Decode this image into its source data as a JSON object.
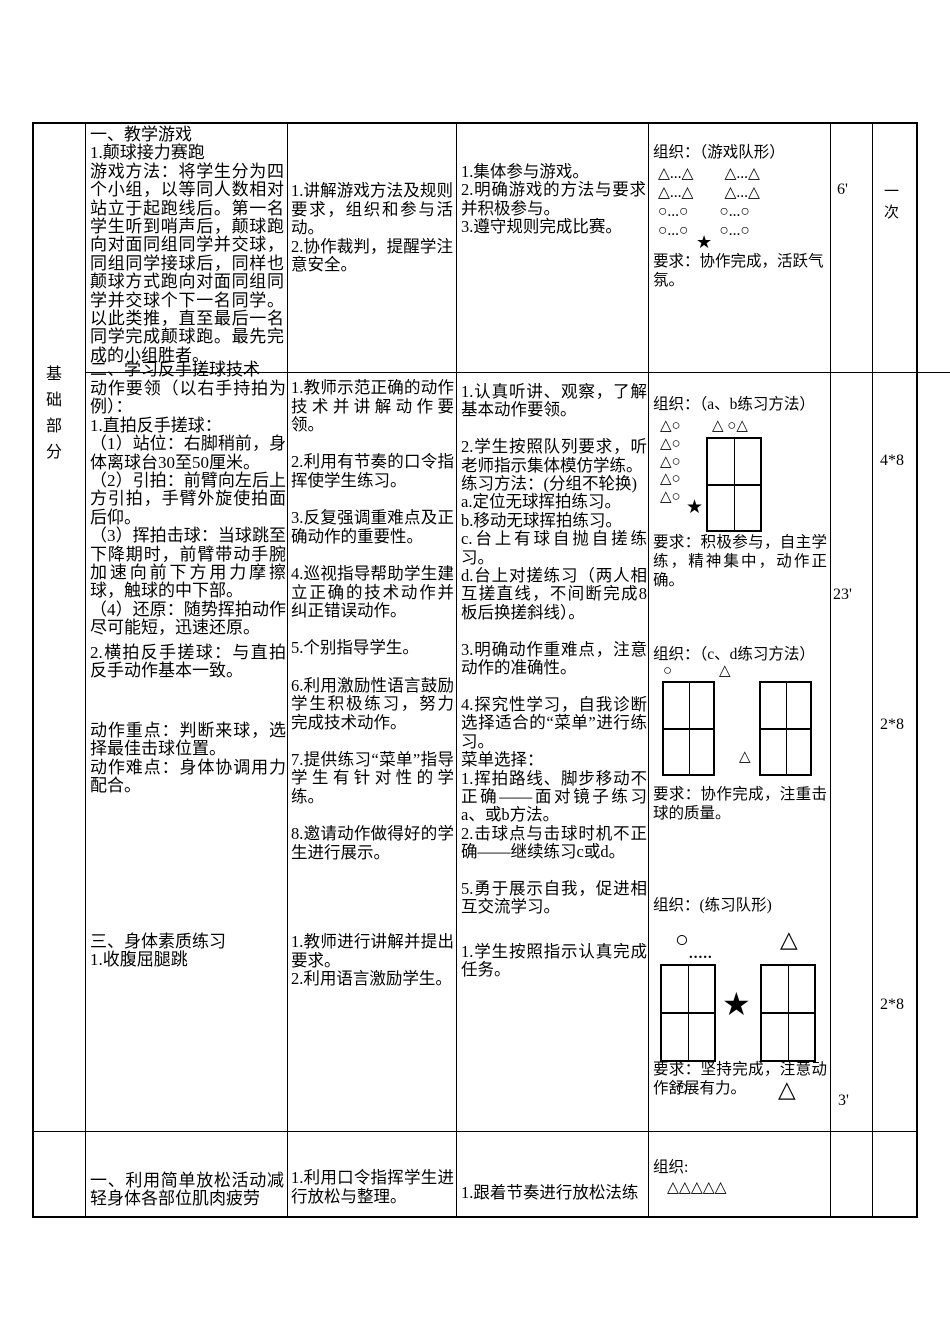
{
  "colors": {
    "background": "#ffffff",
    "text": "#000000",
    "border": "#000000"
  },
  "table": {
    "section_label": "基础部分"
  },
  "row_game": {
    "content_heading": "一、教学游戏",
    "content_sub": "1.颠球接力赛跑",
    "content_body": "游戏方法：将学生分为四个小组，以等同人数相对站立于起跑线后。第一名学生听到哨声后，颠球跑向对面同组同学并交球，同组同学接球后，同样也颠球方式跑向对面同组同学并交球个下一名同学。以此类推，直至最后一名同学完成颠球跑。最先完成的小组胜者。",
    "teacher": "1.讲解游戏方法及规则要求，组织和参与活动。\n2.协作裁判，提醒学注意安全。",
    "student": "1.集体参与游戏。\n2.明确游戏的方法与要求并积极参与。\n3.遵守规则完成比赛。",
    "org_title": "组织：（游戏队形）",
    "formation": "△...△　　△...△\n△...△　　△...△\n○...○　　○...○\n○...○　　○...○",
    "star": "★",
    "requirement": "要求：协作完成，活跃气氛。",
    "time": "6'",
    "count": "一次"
  },
  "row_skill": {
    "content_heading": "二、学习反手搓球技术",
    "content_body": "动作要领（以右手持拍为例）：\n1.直拍反手搓球：\n（1）站位：右脚稍前，身体离球台30至50厘米。\n（2）引拍：前臂向左后上方引拍，手臂外旋使拍面后仰。\n（3）挥拍击球：当球跳至下降期时，前臂带动手腕加速向前下方用力摩擦球，触球的中下部。\n（4）还原：随势挥拍动作尽可能短，迅速还原。",
    "content_body2": "2.横拍反手搓球：与直拍反手动作基本一致。",
    "content_keypoint": "动作重点：判断来球，选择最佳击球位置。\n动作难点：身体协调用力配合。",
    "teacher": "1.教师示范正确的动作技术并讲解动作要领。\n\n2.利用有节奏的口令指挥使学生练习。\n\n3.反复强调重难点及正确动作的重要性。\n\n4.巡视指导帮助学生建立正确的技术动作并纠正错误动作。\n\n5.个别指导学生。\n\n6.利用激励性语言鼓励学生积极练习，努力完成技术动作。\n\n7.提供练习“菜单”指导学生有针对性的学练。\n\n8.邀请动作做得好的学生进行展示。",
    "student": "1.认真听讲、观察，了解基本动作要领。\n\n2.学生按照队列要求，听老师指示集体模仿学练。\n练习方法：(分组不轮换)\na.定位无球挥拍练习。\nb.移动无球挥拍练习。\nc.台上有球自抛自搓练习。\nd.台上对搓练习（两人相互搓直线，不间断完成8板后换搓斜线）。\n\n3.明确动作重难点，注意动作的准确性。\n\n4.探究性学习，自我诊断选择适合的“菜单”进行练习。\n菜单选择：\n1.挥拍路线、脚步移动不正确——面对镜子练习a、或b方法。\n2.击球点与击球时机不正确——继续练习c或d。\n\n5.勇于展示自我，促进相互交流学习。",
    "time": "23'",
    "count_ab": "4*8",
    "count_cd": "2*8"
  },
  "row_fitness": {
    "content": "三、身体素质练习\n1.收腹屈腿跳",
    "teacher": "1.教师进行讲解并提出要求。\n2.利用语言激励学生。",
    "student": "1.学生按照指示认真完成任务。",
    "time": "3'",
    "count": "2*8"
  },
  "org_ab": {
    "title": "组织：（a、b练习方法）",
    "pair": "△○",
    "top_right": "△ ○△",
    "pairs_column": "△○\n△○\n△○\n△○",
    "star": "★",
    "requirement": "要求：积极参与，自主学练，精神集中，动作正确。"
  },
  "org_cd": {
    "title": "组织：（c、d练习方法）",
    "circle": "○",
    "triangle": "△",
    "mid_triangle": "△",
    "requirement": "要求：协作完成，注重击球的质量。"
  },
  "org_drill": {
    "title": "组织：(练习队形)",
    "circle": "○",
    "triangle": "△",
    "dots": ".....",
    "star": "★",
    "requirement": "要求：坚持完成，注意动作舒展有力。",
    "bottom_circle": "○",
    "bottom_triangle": "△"
  },
  "row_relax": {
    "content": "一、利用简单放松活动减轻身体各部位肌肉疲劳",
    "teacher": "1.利用口令指挥学生进行放松与整理。",
    "student": "1.跟着节奏进行放松法练",
    "org_title": "组织:",
    "org_formation": "△△△△△"
  }
}
